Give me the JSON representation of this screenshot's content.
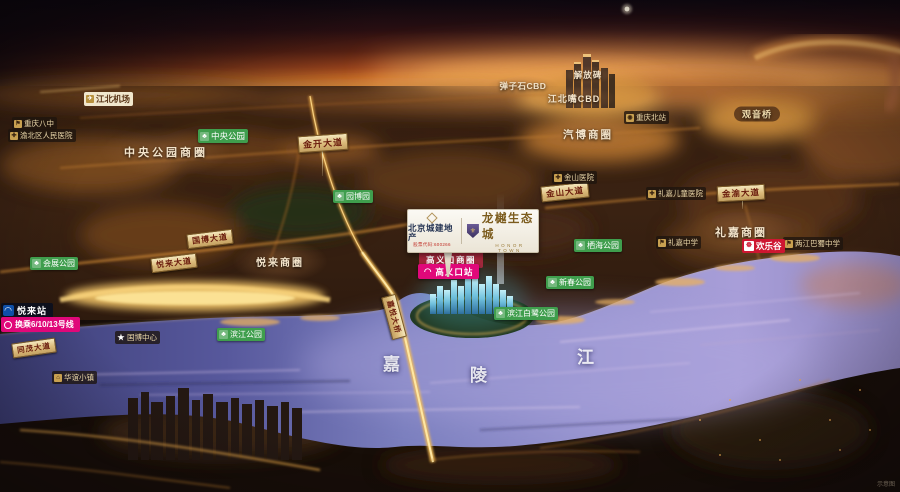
{
  "billboard": {
    "developer": "北京城建地产",
    "developer_tagline": "股票代码:600266",
    "project_name": "龙樾生态城",
    "project_name_en": "HONOR TOWN"
  },
  "river": {
    "name": "嘉陵江",
    "char_1": "嘉",
    "char_2": "陵",
    "char_3": "江"
  },
  "zones": [
    {
      "text": "中央公园商圈"
    },
    {
      "text": "悦来商圈"
    },
    {
      "text": "礼嘉商圈"
    },
    {
      "text": "汽博商圈"
    },
    {
      "text": "江北嘴CBD"
    },
    {
      "text": "弹子石CBD"
    },
    {
      "text": "解放碑"
    },
    {
      "text": "观音桥"
    }
  ],
  "roads": [
    {
      "text": "金开大道"
    },
    {
      "text": "金山大道"
    },
    {
      "text": "金渝大道"
    },
    {
      "text": "国博大道"
    },
    {
      "text": "悦来大道"
    },
    {
      "text": "同茂大道"
    },
    {
      "text": "嘉悦大桥"
    }
  ],
  "parks": [
    {
      "text": "中央公园",
      "icon": "tree-icon"
    },
    {
      "text": "园博园",
      "icon": "tree-icon"
    },
    {
      "text": "会展公园",
      "icon": "tree-icon"
    },
    {
      "text": "栖海公园",
      "icon": "tree-icon"
    },
    {
      "text": "新春公园",
      "icon": "tree-icon"
    },
    {
      "text": "滨江白鹭公园",
      "icon": "tree-icon"
    },
    {
      "text": "滨江公园",
      "icon": "tree-icon"
    }
  ],
  "pois": [
    {
      "text": "江北机场",
      "icon": "plane-icon"
    },
    {
      "text": "重庆八中",
      "icon": "school-flag-icon"
    },
    {
      "text": "渝北区人民医院",
      "icon": "hospital-cross-icon"
    },
    {
      "text": "金山医院",
      "icon": "hospital-cross-icon"
    },
    {
      "text": "礼嘉儿童医院",
      "icon": "hospital-cross-icon"
    },
    {
      "text": "重庆北站",
      "icon": "train-icon"
    },
    {
      "text": "礼嘉中学",
      "icon": "school-flag-icon"
    },
    {
      "text": "两江巴蜀中学",
      "icon": "school-flag-icon"
    },
    {
      "text": "国博中心",
      "icon": "star-icon"
    },
    {
      "text": "华谊小镇",
      "icon": "building-icon"
    },
    {
      "text": "欢乐谷",
      "icon": "ferris-wheel-icon"
    }
  ],
  "transit": {
    "yuelai_station": "悦来站",
    "transfer_note": "换乘6/10/13号线",
    "gaoyikou_station": "高义口站",
    "gaoyikou_district_tag": "高义口商圈"
  },
  "watermark": "示意图"
}
